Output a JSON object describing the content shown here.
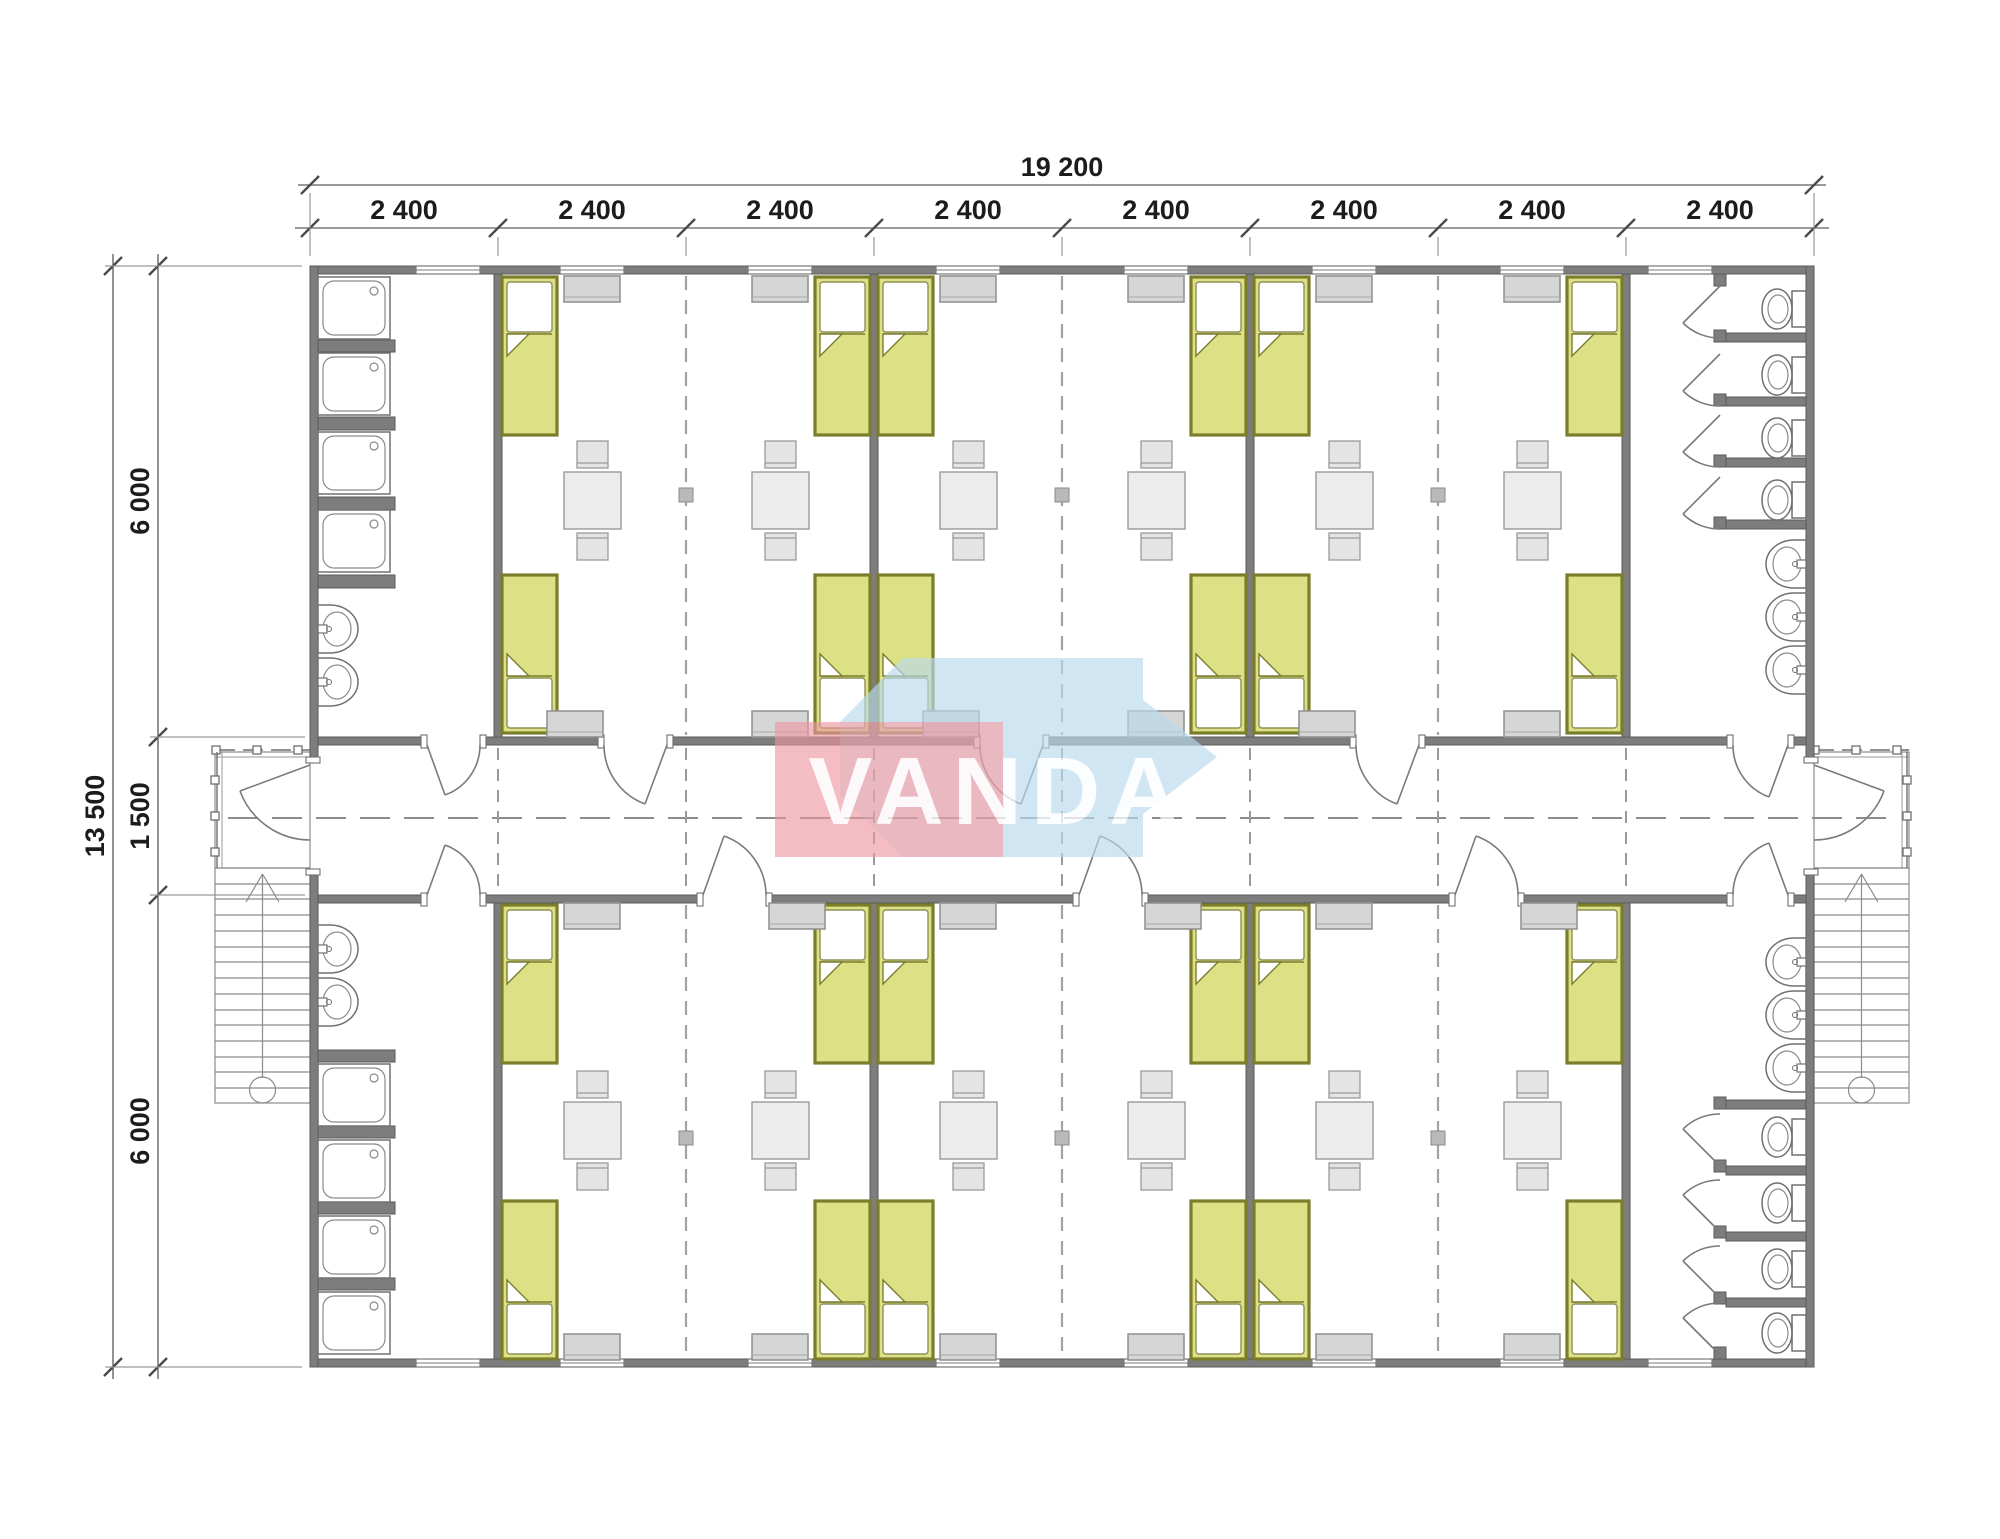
{
  "watermark": {
    "text": "VANDA",
    "red_color": "#ee96a0",
    "blue_color": "#b9d9ec"
  },
  "dimensions": {
    "overall_width": "19 200",
    "overall_height": "13 500",
    "module_widths": [
      "2 400",
      "2 400",
      "2 400",
      "2 400",
      "2 400",
      "2 400",
      "2 400",
      "2 400"
    ],
    "height_segments": [
      "6 000",
      "1 500",
      "6 000"
    ]
  },
  "plan": {
    "colors": {
      "bed_fill": "#dce185",
      "bed_border": "#7c7d2b",
      "wall": "#7d7d7d",
      "furniture_fill": "#ebebeb",
      "fixture_line": "#707070"
    },
    "fixtures": {
      "beds": 16,
      "tables": 12,
      "chairs": 24,
      "showers": 8,
      "wash_basins": 10,
      "toilets": 8,
      "entrances": 2,
      "stairs": 2
    }
  }
}
